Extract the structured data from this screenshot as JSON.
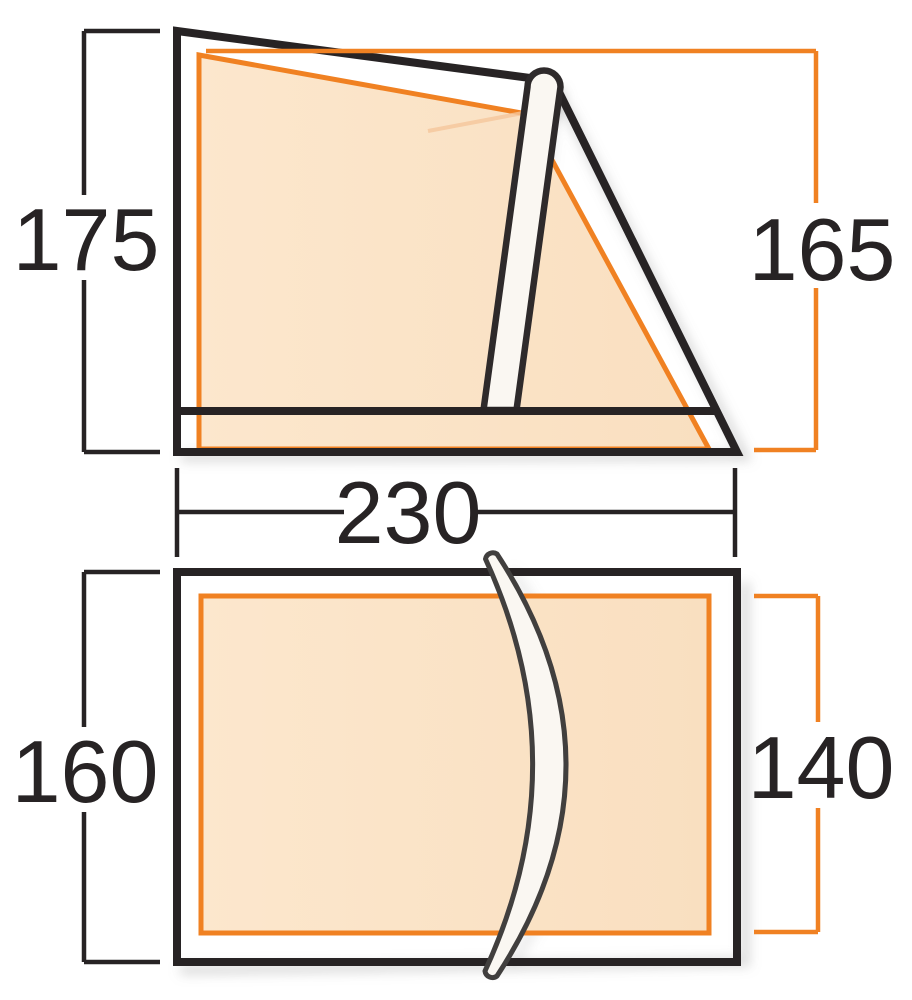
{
  "colors": {
    "accent": "#F08122",
    "line": "#272324",
    "fabric": "#FBE4C7",
    "pole": "#FAF7F2",
    "poleline": "#2E2A2B"
  },
  "side_view": {
    "outer_height": "175",
    "inner_height": "165",
    "width": "230"
  },
  "floor_view": {
    "outer_depth": "160",
    "inner_depth": "140"
  }
}
